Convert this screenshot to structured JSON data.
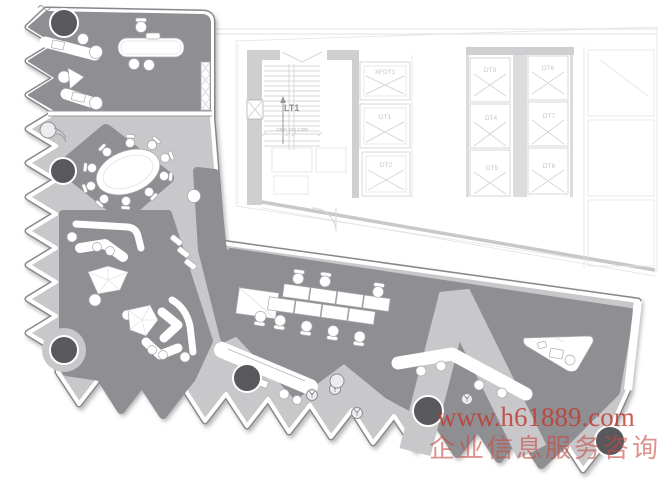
{
  "watermark": {
    "line1": "www.h61889.com",
    "line2": "企业信息服务咨询"
  },
  "base_plan": {
    "stair": {
      "label": "LT1",
      "dimension": "1300 100 1300"
    },
    "elevators": [
      {
        "id": "XFDT1"
      },
      {
        "id": "DT1"
      },
      {
        "id": "DT2"
      },
      {
        "id": "DT3"
      },
      {
        "id": "DT4"
      },
      {
        "id": "DT5"
      },
      {
        "id": "DT6"
      },
      {
        "id": "DT7"
      },
      {
        "id": "DT8"
      }
    ]
  },
  "colors": {
    "floor": "#c8c8cb",
    "zone": "#8f8f93",
    "column": "#59595d",
    "faint_plan": "#d7d7da",
    "watermark_red": "#bf3a2f"
  }
}
